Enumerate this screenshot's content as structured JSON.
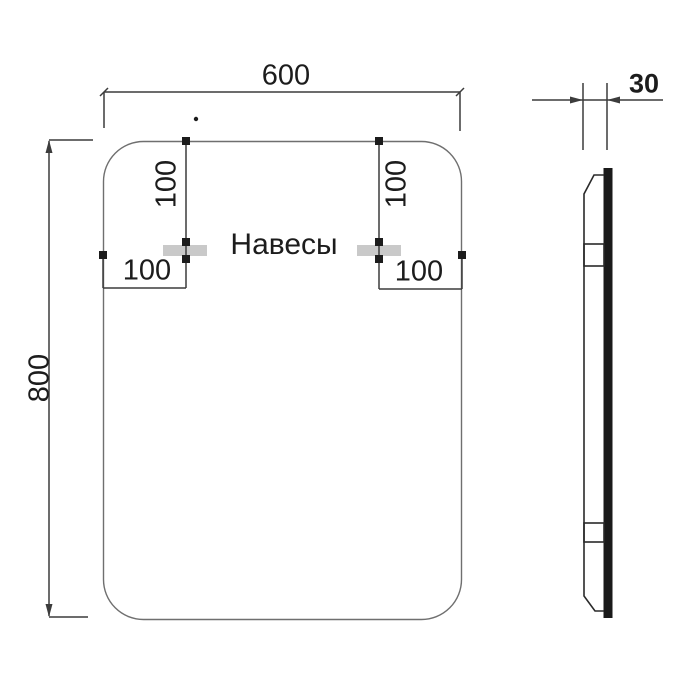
{
  "drawing": {
    "front_view": {
      "width_label": "600",
      "height_label": "800",
      "mounts_label": "Навесы",
      "mount_top_offset_left": "100",
      "mount_top_offset_right": "100",
      "mount_side_offset_left": "100",
      "mount_side_offset_right": "100"
    },
    "side_view": {
      "depth_label": "30"
    },
    "colors": {
      "dimension_line": "#3c3c3c",
      "mirror_outline": "#6f6f6f",
      "profile_outline": "#2a2a2a",
      "mount_plate": "#c9c9c9",
      "glass_edge": "#1a1a1a",
      "marker": "#1c1c1c",
      "text": "#1c1c1c"
    }
  }
}
